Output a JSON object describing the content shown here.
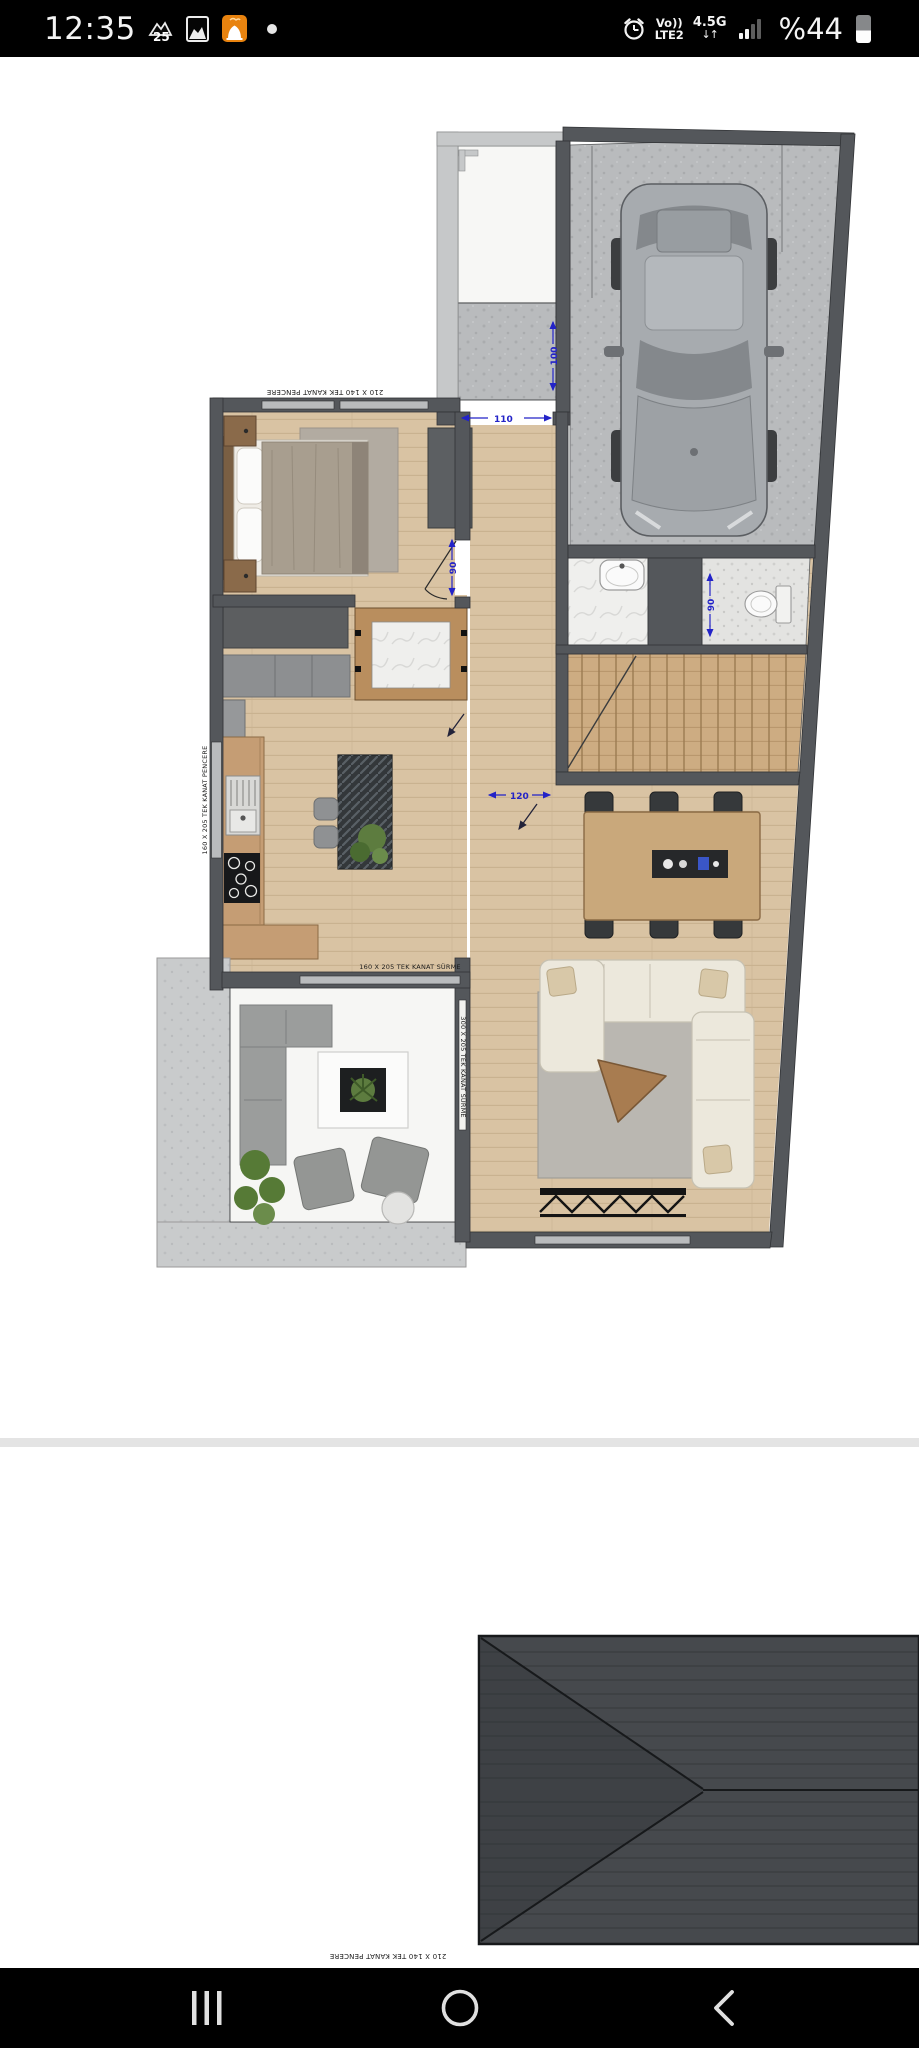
{
  "status_bar": {
    "time": "12:35",
    "screenshot_badge": "25",
    "volte_top": "Vo))",
    "volte_bottom": "LTE2",
    "network": "4.5G",
    "net_arrows": "↓↑",
    "battery_percent": "%44"
  },
  "floor_plan": {
    "dimensions": {
      "entry_width": "110",
      "pad_depth": "100",
      "bedroom_door": "90",
      "wc_door": "90",
      "kitchen_opening": "120"
    },
    "labels": {
      "bedroom_window": "210 X 140 TEK KANAT PENCERE",
      "kitchen_window": "160 X 205 TEK KANAT PENCERE",
      "terrace_slider_top": "160 X 205 TEK KANAT SÜRME",
      "terrace_slider_right": "300 X 205 TEK KANAT SÜRME"
    }
  },
  "roof_plan": {
    "bottom_label": "210 X 140 TEK KANAT PENCERE"
  }
}
